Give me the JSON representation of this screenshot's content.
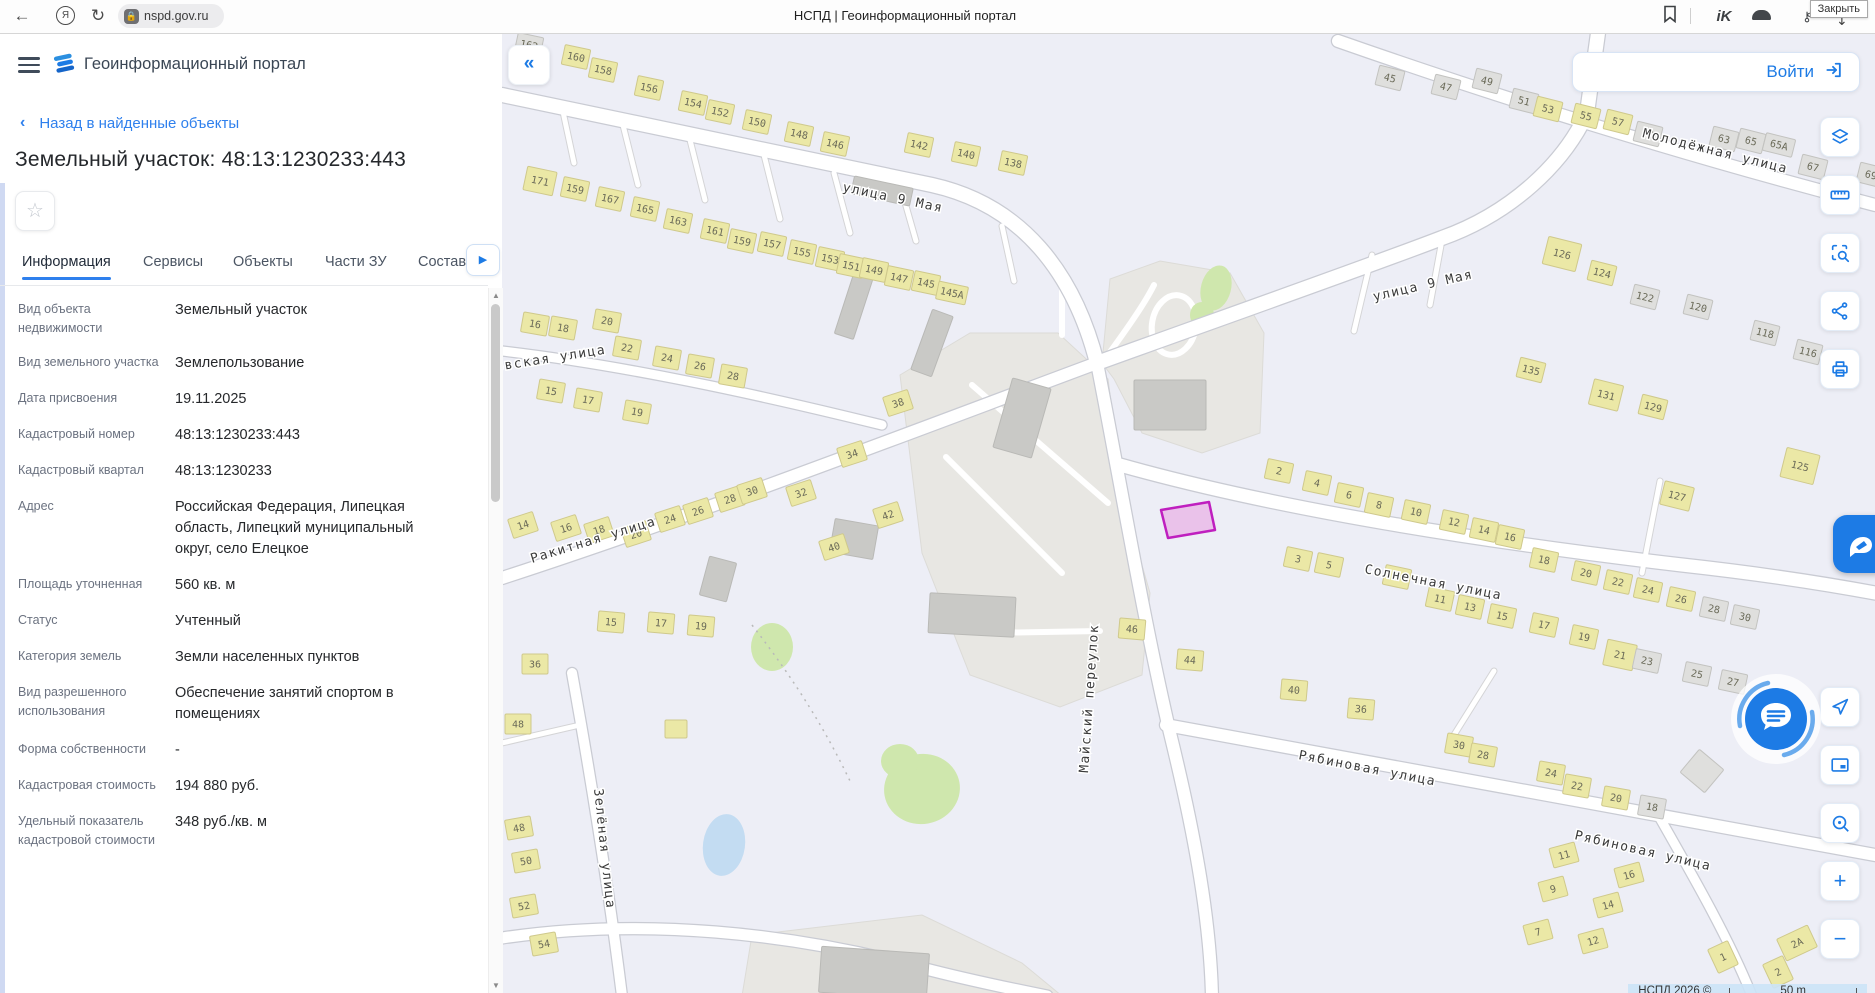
{
  "browser": {
    "url": "nspd.gov.ru",
    "page_title": "НСПД | Геоинформационный портал",
    "tooltip": "Закрыть"
  },
  "header": {
    "title": "Геоинформационный портал"
  },
  "panel": {
    "back_label": "Назад в найденные объекты",
    "title": "Земельный участок: 48:13:1230233:443",
    "tabs": [
      "Информация",
      "Сервисы",
      "Объекты",
      "Части ЗУ",
      "Состав"
    ],
    "active_tab": "Информация",
    "fields": [
      {
        "label": "Вид объекта недвижимости",
        "value": "Земельный участок"
      },
      {
        "label": "Вид земельного участка",
        "value": "Землепользование"
      },
      {
        "label": "Дата присвоения",
        "value": "19.11.2025"
      },
      {
        "label": "Кадастровый номер",
        "value": "48:13:1230233:443"
      },
      {
        "label": "Кадастровый квартал",
        "value": "48:13:1230233"
      },
      {
        "label": "Адрес",
        "value": "Российская Федерация, Липецкая область, Липецкий муниципальный округ, село Елецкое"
      },
      {
        "label": "Площадь уточненная",
        "value": "560 кв. м"
      },
      {
        "label": "Статус",
        "value": "Учтенный"
      },
      {
        "label": "Категория земель",
        "value": "Земли населенных пунктов"
      },
      {
        "label": "Вид разрешенного использования",
        "value": "Обеспечение занятий спортом в помещениях"
      },
      {
        "label": "Форма собственности",
        "value": "-"
      },
      {
        "label": "Кадастровая стоимость",
        "value": "194 880 руб."
      },
      {
        "label": "Удельный показатель кадастровой стоимости",
        "value": "348 руб./кв. м"
      }
    ]
  },
  "map": {
    "login_label": "Войти",
    "attribution": "НСПД 2026 ©",
    "scale_label": "50 m",
    "tools_top": [
      "layers",
      "ruler",
      "select-search",
      "share",
      "print"
    ],
    "tools_bottom": [
      "navigate",
      "mini-map",
      "search-location",
      "zoom-in",
      "zoom-out"
    ],
    "colors": {
      "bg": "#edeef6",
      "zone": "#e8e7e3",
      "zoneStroke": "#dcdbd7",
      "roadCasing": "#c9cbd3",
      "road": "#ffffff",
      "yellow": "#ebe8a6",
      "yellowStroke": "#cfc98c",
      "gray": "#dfdfdd",
      "grayStroke": "#c3c3c0",
      "plant": "#c9c9c6",
      "plantStroke": "#b9b9b6",
      "green": "#cfe7ad",
      "water": "#c3dcf2",
      "parcelFill": "rgba(231,158,224,0.55)",
      "parcelStroke": "#bf1fbf",
      "label": "#3b3b3b",
      "bldLabel": "#6a6a58"
    },
    "parcel": "659,477 707,469 713,497 666,505",
    "zones": [
      "398,342 468,300 556,300 606,346 622,470 648,560 640,642 558,674 468,642 420,520",
      "600,330 608,246 658,228 728,240 762,300 758,400 700,420 640,400 612,346",
      "240,963 250,902 420,882 520,930 560,963"
    ],
    "greens": [
      {
        "cx": 714,
        "cy": 255,
        "rx": 15,
        "ry": 23,
        "rot": 15
      },
      {
        "cx": 700,
        "cy": 282,
        "rx": 12,
        "ry": 13,
        "rot": 0
      },
      {
        "cx": 270,
        "cy": 614,
        "rx": 21,
        "ry": 24,
        "rot": 0
      },
      {
        "cx": 420,
        "cy": 756,
        "rx": 38,
        "ry": 35,
        "rot": -10
      },
      {
        "cx": 398,
        "cy": 728,
        "rx": 19,
        "ry": 17,
        "rot": 0
      }
    ],
    "pond": {
      "cx": 222,
      "cy": 812,
      "rx": 21,
      "ry": 31,
      "rot": 8
    },
    "roads": [
      {
        "d": "M0,62 L430,152 C520,172 572,240 595,330",
        "w": 14
      },
      {
        "d": "M595,330 C700,292 870,232 940,205 C1010,180 1062,130 1085,80 L1096,0",
        "w": 14
      },
      {
        "d": "M836,8 C990,62 1180,122 1373,172",
        "w": 12
      },
      {
        "d": "M595,330 C615,430 640,580 668,700 C690,790 708,880 710,963",
        "w": 12
      },
      {
        "d": "M618,432 C760,472 950,505 1180,532 C1270,542 1330,552 1373,560",
        "w": 13
      },
      {
        "d": "M0,545 C200,480 420,395 595,330",
        "w": 12
      },
      {
        "d": "M0,318 C120,332 250,360 380,392",
        "w": 9
      },
      {
        "d": "M664,692 L1373,822",
        "w": 12
      },
      {
        "d": "M1155,780 C1195,850 1228,908 1250,963",
        "w": 9
      },
      {
        "d": "M70,640 C88,740 106,850 120,963",
        "w": 10
      },
      {
        "d": "M0,905 C140,884 290,900 420,935 C470,948 520,958 545,963",
        "w": 11
      }
    ],
    "stubs": [
      "M120,88 L136,152",
      "M187,103 L203,167",
      "M262,122 L278,186",
      "M332,140 L348,200",
      "M398,152 L414,208",
      "M60,74 L72,130",
      "M870,222 L852,298",
      "M940,207 L928,272",
      "M1158,448 L1140,540",
      "M952,702 L992,638",
      "M78,692 L0,710",
      "M500,193 L512,248"
    ],
    "driveways": [
      "M600,330 C622,300 642,272 652,252",
      "M470,352 L606,470",
      "M444,424 L560,540",
      "M482,600 L598,598",
      "M560,302 L560,250"
    ],
    "loop": {
      "cx": 672,
      "cy": 292,
      "rx": 22,
      "ry": 30,
      "rot": 10
    },
    "dashed": "M250,592 C295,650 325,700 348,748",
    "plant_buildings": [
      [
        668,
        372,
        72,
        50,
        0
      ],
      [
        520,
        385,
        40,
        72,
        16
      ],
      [
        430,
        310,
        22,
        64,
        20
      ],
      [
        380,
        158,
        60,
        18,
        12
      ],
      [
        470,
        582,
        86,
        40,
        3
      ],
      [
        352,
        506,
        44,
        34,
        10
      ],
      [
        352,
        272,
        20,
        66,
        18
      ],
      [
        216,
        546,
        28,
        40,
        15
      ],
      [
        372,
        940,
        108,
        46,
        4
      ]
    ],
    "buildings": [
      [
        27,
        12,
        "162",
        "g",
        12
      ],
      [
        74,
        24,
        "160",
        "y",
        12
      ],
      [
        101,
        37,
        "158",
        "y",
        12
      ],
      [
        147,
        55,
        "156",
        "y",
        12
      ],
      [
        191,
        70,
        "154",
        "y",
        12
      ],
      [
        218,
        79,
        "152",
        "y",
        12
      ],
      [
        255,
        89,
        "150",
        "y",
        12
      ],
      [
        297,
        101,
        "148",
        "y",
        12
      ],
      [
        333,
        111,
        "146",
        "y",
        12
      ],
      [
        417,
        112,
        "142",
        "y",
        12
      ],
      [
        464,
        121,
        "140",
        "y",
        12
      ],
      [
        511,
        130,
        "138",
        "y",
        12
      ],
      [
        38,
        148,
        "171",
        "y",
        12,
        30,
        24
      ],
      [
        73,
        156,
        "159",
        "y",
        12
      ],
      [
        108,
        166,
        "167",
        "y",
        12
      ],
      [
        143,
        176,
        "165",
        "y",
        12
      ],
      [
        176,
        188,
        "163",
        "y",
        12
      ],
      [
        213,
        198,
        "161",
        "y",
        12
      ],
      [
        240,
        208,
        "159",
        "y",
        12
      ],
      [
        270,
        211,
        "157",
        "y",
        12
      ],
      [
        300,
        219,
        "155",
        "y",
        12
      ],
      [
        328,
        226,
        "153",
        "y",
        12
      ],
      [
        349,
        233,
        "151",
        "y",
        12
      ],
      [
        372,
        237,
        "149",
        "y",
        12
      ],
      [
        397,
        245,
        "147",
        "y",
        12
      ],
      [
        424,
        250,
        "145",
        "y",
        12
      ],
      [
        450,
        260,
        "145A",
        "y",
        12,
        30,
        18
      ],
      [
        33,
        291,
        "16",
        "y",
        10
      ],
      [
        61,
        295,
        "18",
        "y",
        10
      ],
      [
        105,
        288,
        "20",
        "y",
        10
      ],
      [
        125,
        315,
        "22",
        "y",
        10
      ],
      [
        165,
        325,
        "24",
        "y",
        10
      ],
      [
        198,
        333,
        "26",
        "y",
        10
      ],
      [
        231,
        343,
        "28",
        "y",
        10
      ],
      [
        49,
        358,
        "15",
        "y",
        10
      ],
      [
        86,
        367,
        "17",
        "y",
        10
      ],
      [
        135,
        379,
        "19",
        "y",
        10
      ],
      [
        21,
        492,
        "14",
        "y",
        -18
      ],
      [
        64,
        495,
        "16",
        "y",
        -18
      ],
      [
        97,
        497,
        "18",
        "y",
        -18
      ],
      [
        134,
        501,
        "20",
        "y",
        -18
      ],
      [
        168,
        486,
        "24",
        "y",
        -18
      ],
      [
        196,
        478,
        "26",
        "y",
        -18
      ],
      [
        228,
        466,
        "28",
        "y",
        -18
      ],
      [
        250,
        458,
        "30",
        "y",
        -18
      ],
      [
        299,
        460,
        "32",
        "y",
        -18
      ],
      [
        350,
        421,
        "34",
        "y",
        -18
      ],
      [
        396,
        370,
        "38",
        "y",
        -18
      ],
      [
        386,
        482,
        "42",
        "y",
        -18
      ],
      [
        332,
        514,
        "40",
        "y",
        -18
      ],
      [
        33,
        631,
        "36",
        "y",
        0
      ],
      [
        16,
        691,
        "48",
        "y",
        0
      ],
      [
        174,
        696,
        "",
        "y",
        0,
        22,
        18
      ],
      [
        17,
        795,
        "48",
        "y",
        -10
      ],
      [
        24,
        828,
        "50",
        "y",
        -10
      ],
      [
        22,
        873,
        "52",
        "y",
        -10
      ],
      [
        42,
        911,
        "54",
        "y",
        -10
      ],
      [
        109,
        589,
        "15",
        "y",
        5
      ],
      [
        159,
        590,
        "17",
        "y",
        5
      ],
      [
        199,
        593,
        "19",
        "y",
        5
      ],
      [
        888,
        45,
        "45",
        "g",
        14
      ],
      [
        944,
        54,
        "47",
        "g",
        14
      ],
      [
        985,
        48,
        "49",
        "g",
        14
      ],
      [
        1022,
        68,
        "51",
        "g",
        14
      ],
      [
        1046,
        76,
        "53",
        "y",
        14
      ],
      [
        1084,
        83,
        "55",
        "y",
        14
      ],
      [
        1116,
        89,
        "57",
        "y",
        14
      ],
      [
        1146,
        101,
        "59",
        "g",
        14
      ],
      [
        1222,
        106,
        "63",
        "g",
        14
      ],
      [
        1249,
        108,
        "65",
        "g",
        14
      ],
      [
        1277,
        112,
        "65A",
        "g",
        14,
        30,
        18
      ],
      [
        1311,
        134,
        "67",
        "g",
        14
      ],
      [
        1369,
        142,
        "69",
        "g",
        14
      ],
      [
        1060,
        221,
        "126",
        "y",
        14,
        34,
        28
      ],
      [
        1100,
        240,
        "124",
        "y",
        14
      ],
      [
        1143,
        264,
        "122",
        "g",
        14
      ],
      [
        1196,
        274,
        "120",
        "g",
        14
      ],
      [
        1263,
        300,
        "118",
        "g",
        14
      ],
      [
        1306,
        319,
        "116",
        "g",
        14
      ],
      [
        1029,
        337,
        "135",
        "y",
        14
      ],
      [
        1104,
        362,
        "131",
        "y",
        14,
        30,
        26
      ],
      [
        1151,
        374,
        "129",
        "y",
        14
      ],
      [
        1298,
        433,
        "125",
        "y",
        14,
        34,
        30
      ],
      [
        1175,
        463,
        "127",
        "y",
        14,
        30,
        24
      ],
      [
        777,
        438,
        "2",
        "y",
        12
      ],
      [
        815,
        450,
        "4",
        "y",
        12
      ],
      [
        847,
        462,
        "6",
        "y",
        12
      ],
      [
        877,
        472,
        "8",
        "y",
        12
      ],
      [
        914,
        479,
        "10",
        "y",
        12
      ],
      [
        952,
        489,
        "12",
        "y",
        12
      ],
      [
        982,
        497,
        "14",
        "y",
        12
      ],
      [
        1008,
        504,
        "16",
        "y",
        12
      ],
      [
        1042,
        527,
        "18",
        "y",
        12
      ],
      [
        1084,
        540,
        "20",
        "y",
        12
      ],
      [
        1116,
        549,
        "22",
        "y",
        12
      ],
      [
        1146,
        557,
        "24",
        "y",
        12
      ],
      [
        1179,
        566,
        "26",
        "y",
        12
      ],
      [
        1212,
        576,
        "28",
        "g",
        12
      ],
      [
        1243,
        584,
        "30",
        "g",
        12
      ],
      [
        796,
        526,
        "3",
        "y",
        12
      ],
      [
        827,
        532,
        "5",
        "y",
        12
      ],
      [
        895,
        544,
        "9",
        "y",
        12
      ],
      [
        938,
        566,
        "11",
        "y",
        12
      ],
      [
        968,
        574,
        "13",
        "y",
        12
      ],
      [
        1000,
        583,
        "15",
        "y",
        12
      ],
      [
        1042,
        592,
        "17",
        "y",
        12
      ],
      [
        1082,
        604,
        "19",
        "y",
        12
      ],
      [
        1118,
        622,
        "21",
        "y",
        12,
        30,
        26
      ],
      [
        1145,
        628,
        "23",
        "g",
        12
      ],
      [
        1195,
        641,
        "25",
        "g",
        12
      ],
      [
        1231,
        649,
        "27",
        "g",
        12
      ],
      [
        630,
        596,
        "46",
        "y",
        5
      ],
      [
        688,
        627,
        "44",
        "y",
        5
      ],
      [
        792,
        657,
        "40",
        "y",
        5
      ],
      [
        859,
        676,
        "36",
        "y",
        5
      ],
      [
        957,
        712,
        "30",
        "y",
        10
      ],
      [
        981,
        722,
        "28",
        "y",
        10
      ],
      [
        1049,
        740,
        "24",
        "y",
        10
      ],
      [
        1075,
        753,
        "22",
        "y",
        10
      ],
      [
        1114,
        765,
        "20",
        "y",
        10
      ],
      [
        1150,
        774,
        "18",
        "g",
        10
      ],
      [
        1062,
        822,
        "11",
        "y",
        -15
      ],
      [
        1127,
        842,
        "16",
        "y",
        -15
      ],
      [
        1051,
        856,
        "9",
        "y",
        -15
      ],
      [
        1106,
        872,
        "14",
        "y",
        -15
      ],
      [
        1036,
        899,
        "7",
        "y",
        -15
      ],
      [
        1091,
        908,
        "12",
        "y",
        -15
      ],
      [
        1295,
        910,
        "2А",
        "y",
        -25,
        34,
        24
      ],
      [
        1221,
        924,
        "1",
        "y",
        -25,
        22,
        26
      ],
      [
        1276,
        939,
        "2",
        "y",
        -25,
        22,
        26
      ],
      [
        1200,
        738,
        "",
        "g",
        40,
        32,
        30
      ]
    ],
    "streets": [
      {
        "t": "улица 9 Мая",
        "x": 340,
        "y": 158,
        "r": 12
      },
      {
        "t": "улица 9 Мая",
        "x": 872,
        "y": 268,
        "r": -13
      },
      {
        "t": "Молодёжная улица",
        "x": 1140,
        "y": 104,
        "r": 14
      },
      {
        "t": "Солнечная улица",
        "x": 862,
        "y": 540,
        "r": 11
      },
      {
        "t": "Ракитная улица",
        "x": 30,
        "y": 530,
        "r": -17
      },
      {
        "t": "овская улица",
        "x": -6,
        "y": 338,
        "r": -9
      },
      {
        "t": "Майский переулок",
        "x": 586,
        "y": 740,
        "r": -86
      },
      {
        "t": "Рябиновая улица",
        "x": 796,
        "y": 726,
        "r": 11
      },
      {
        "t": "Рябиновая улица",
        "x": 1072,
        "y": 806,
        "r": 13
      },
      {
        "t": "Зелёная улица",
        "x": 92,
        "y": 756,
        "r": 84
      }
    ]
  }
}
